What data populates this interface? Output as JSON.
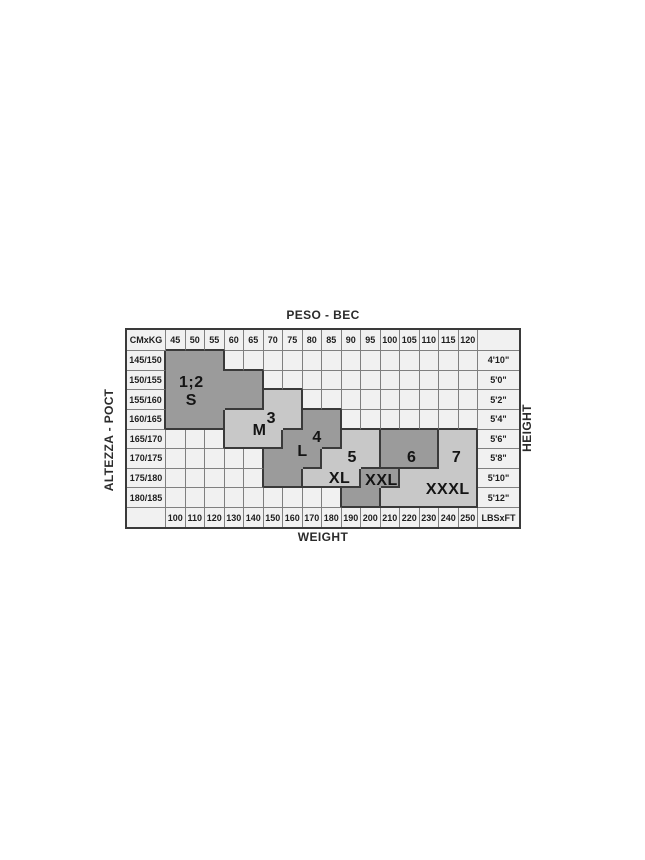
{
  "chart_data": {
    "type": "table",
    "title_top": "PESO - ВЕС",
    "title_bottom": "WEIGHT",
    "ylabel_left": "ALTEZZA - РОСТ",
    "ylabel_right": "HEIGHT",
    "corner_top_left": "CMxKG",
    "corner_bottom_right": "LBSxFT",
    "kg_columns": [
      "45",
      "50",
      "55",
      "60",
      "65",
      "70",
      "75",
      "80",
      "85",
      "90",
      "95",
      "100",
      "105",
      "110",
      "115",
      "120"
    ],
    "lbs_columns": [
      "100",
      "110",
      "120",
      "130",
      "140",
      "150",
      "160",
      "170",
      "180",
      "190",
      "200",
      "210",
      "220",
      "230",
      "240",
      "250"
    ],
    "cm_rows": [
      "145/150",
      "150/155",
      "155/160",
      "160/165",
      "165/170",
      "170/175",
      "175/180",
      "180/185"
    ],
    "ft_rows": [
      "4'10\"",
      "5'0\"",
      "5'2\"",
      "5'4\"",
      "5'6\"",
      "5'8\"",
      "5'10\"",
      "5'12\""
    ],
    "regions": {
      "S": "dark",
      "M": "light",
      "L": "dark",
      "XL": "light",
      "XXL": "dark",
      "SIX": "dark",
      "SVN": "light"
    },
    "region_grid": [
      [
        "S",
        "S",
        "S",
        "",
        "",
        "",
        "",
        "",
        "",
        "",
        "",
        "",
        "",
        "",
        "",
        ""
      ],
      [
        "S",
        "S",
        "S",
        "S",
        "S",
        "",
        "",
        "",
        "",
        "",
        "",
        "",
        "",
        "",
        "",
        ""
      ],
      [
        "S",
        "S",
        "S",
        "S",
        "S",
        "M",
        "M",
        "",
        "",
        "",
        "",
        "",
        "",
        "",
        "",
        ""
      ],
      [
        "S",
        "S",
        "S",
        "M",
        "M",
        "M",
        "M",
        "L",
        "L",
        "",
        "",
        "",
        "",
        "",
        "",
        ""
      ],
      [
        "",
        "",
        "",
        "M",
        "M",
        "M",
        "L",
        "L",
        "L",
        "XL",
        "XL",
        "SIX",
        "SIX",
        "SIX",
        "SVN",
        "SVN"
      ],
      [
        "",
        "",
        "",
        "",
        "",
        "L",
        "L",
        "L",
        "XL",
        "XL",
        "XL",
        "SIX",
        "SIX",
        "SIX",
        "SVN",
        "SVN"
      ],
      [
        "",
        "",
        "",
        "",
        "",
        "L",
        "L",
        "XL",
        "XL",
        "XL",
        "XXL",
        "XXL",
        "SVN",
        "SVN",
        "SVN",
        "SVN"
      ],
      [
        "",
        "",
        "",
        "",
        "",
        "",
        "",
        "",
        "",
        "XXL",
        "XXL",
        "SVN",
        "SVN",
        "SVN",
        "SVN",
        "SVN"
      ]
    ],
    "size_labels": [
      {
        "text": "1;2",
        "col": 1.3,
        "row": 1.65
      },
      {
        "text": "S",
        "col": 1.3,
        "row": 2.55
      },
      {
        "text": "3",
        "col": 5.4,
        "row": 3.45
      },
      {
        "text": "M",
        "col": 4.8,
        "row": 4.1
      },
      {
        "text": "4",
        "col": 7.75,
        "row": 4.45
      },
      {
        "text": "L",
        "col": 7.0,
        "row": 5.15
      },
      {
        "text": "5",
        "col": 9.55,
        "row": 5.45
      },
      {
        "text": "XL",
        "col": 8.9,
        "row": 6.5
      },
      {
        "text": "XXL",
        "col": 11.05,
        "row": 6.6
      },
      {
        "text": "6",
        "col": 12.6,
        "row": 5.45
      },
      {
        "text": "7",
        "col": 14.9,
        "row": 5.45
      },
      {
        "text": "XXXL",
        "col": 14.45,
        "row": 7.1
      }
    ],
    "colors": {
      "dark": "#9b9b9b",
      "light": "#c8c8c8",
      "cell": "#f1f1f1",
      "grid": "#808080",
      "frame": "#3a3a3a",
      "page_background": "#ffffff"
    }
  }
}
